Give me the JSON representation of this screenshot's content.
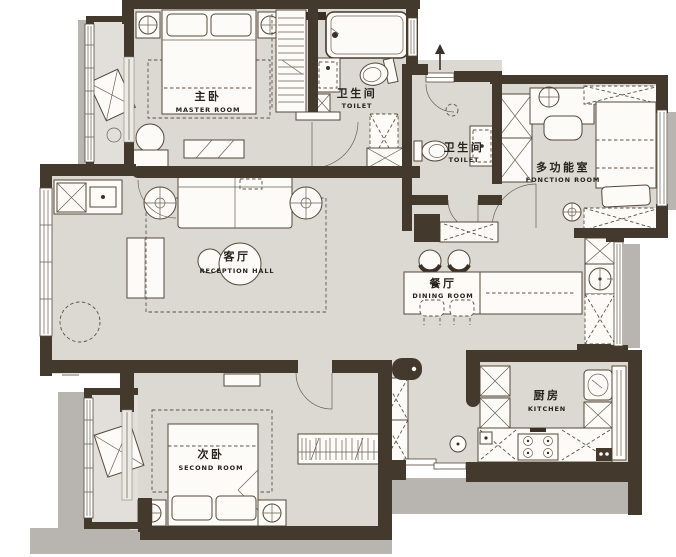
{
  "plan": {
    "title": "apartment-floor-plan",
    "colors": {
      "background": "#ffffff",
      "wall": "#44392d",
      "floor": "#dcd9d3",
      "furniture": "#fcfbf8",
      "shadow": "#b8b5b1",
      "text": "#26211b"
    },
    "rooms": [
      {
        "id": "master-bedroom",
        "label_zh": "主卧",
        "label_en": "MASTER ROOM"
      },
      {
        "id": "bathroom-main",
        "label_zh": "卫生间",
        "label_en": "TOILET"
      },
      {
        "id": "bathroom-guest",
        "label_zh": "卫生间",
        "label_en": "TOILET"
      },
      {
        "id": "function-room",
        "label_zh": "多功能室",
        "label_en": "FONCTION ROOM"
      },
      {
        "id": "living-room",
        "label_zh": "客厅",
        "label_en": "RECEPTION HALL"
      },
      {
        "id": "dining-room",
        "label_zh": "餐厅",
        "label_en": "DINING ROOM"
      },
      {
        "id": "second-bedroom",
        "label_zh": "次卧",
        "label_en": "SECOND ROOM"
      },
      {
        "id": "kitchen",
        "label_zh": "厨房",
        "label_en": "KITCHEN"
      }
    ]
  }
}
